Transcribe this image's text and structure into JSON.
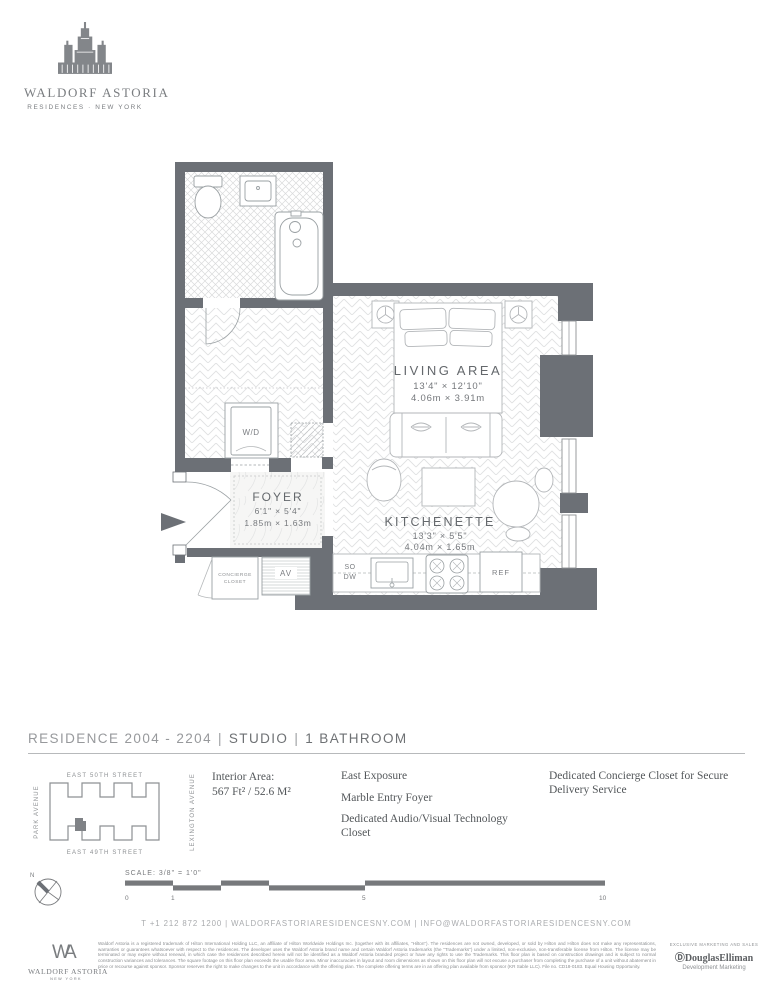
{
  "brand": {
    "name": "WALDORF ASTORIA",
    "subtitle": "RESIDENCES · NEW YORK"
  },
  "plan": {
    "living": {
      "label": "LIVING AREA",
      "dim_ft": "13'4\" × 12'10\"",
      "dim_m": "4.06m × 3.91m"
    },
    "kitchenette": {
      "label": "KITCHENETTE",
      "dim_ft": "13'3\" × 5'5\"",
      "dim_m": "4.04m × 1.65m"
    },
    "foyer": {
      "label": "FOYER",
      "dim_ft": "6'1\" × 5'4\"",
      "dim_m": "1.85m × 1.63m"
    },
    "wd": "W/D",
    "concierge_line1": "CONCIERGE",
    "concierge_line2": "CLOSET",
    "av": "AV",
    "so": "SO",
    "dw": "DW",
    "ref": "REF"
  },
  "residence": {
    "title_residence": "RESIDENCE 2004 - 2204",
    "title_type": "STUDIO",
    "title_bath": "1 BATHROOM",
    "sep": "|"
  },
  "keyplan": {
    "street_top": "EAST 50TH STREET",
    "street_bottom": "EAST 49TH STREET",
    "avenue_left": "PARK AVENUE",
    "avenue_right": "LEXINGTON AVENUE"
  },
  "details": {
    "interior_area_label": "Interior Area:",
    "interior_area_value": "567 Ft² / 52.6 M²",
    "features_col1": [
      "East Exposure",
      "Marble Entry Foyer",
      "Dedicated Audio/Visual Technology Closet"
    ],
    "features_col2": [
      "Dedicated Concierge Closet for Secure Delivery Service"
    ]
  },
  "scale": {
    "north": "N",
    "label": "SCALE: 3/8\" = 1'0\"",
    "ticks": [
      "0",
      "1",
      "5",
      "10"
    ]
  },
  "contact": "T +1 212 872 1200  |  WALDORFASTORIARESIDENCESNY.COM  |  INFO@WALDORFASTORIARESIDENCESNY.COM",
  "footer": {
    "monogram": "WA",
    "logo_name": "WALDORF ASTORIA",
    "logo_sub": "NEW YORK",
    "disclaimer": "Waldorf Astoria is a registered trademark of Hilton International Holding LLC, an affiliate of Hilton Worldwide Holdings Inc. (together with its affiliates, \"Hilton\"). The residences are not owned, developed, or sold by Hilton and Hilton does not make any representations, warranties or guarantees whatsoever with respect to the residences. The developer uses the Waldorf Astoria brand name and certain Waldorf Astoria trademarks (the \"Trademarks\") under a limited, non-exclusive, non-transferable license from Hilton. The license may be terminated or may expire without renewal, in which case the residences described herein will not be identified as a Waldorf Astoria branded project or have any rights to use the Trademarks. This floor plan is based on construction drawings and is subject to normal construction variances and tolerances. The square footage on this floor plan exceeds the usable floor area. Minor inaccuracies in layout and room dimensions as shown on this floor plan will not excuse a purchaser from completing the purchase of a unit without abatement in price or recourse against sponsor. Sponsor reserves the right to make changes to the unit in accordance with the offering plan. The complete offering terms are in an offering plan available from sponsor (KR Sable LLC). File no. CD18-0183. Equal Housing Opportunity.",
    "marketing_label": "EXCLUSIVE MARKETING AND SALES",
    "agency_mark": "Ⓓ",
    "agency": "DouglasElliman",
    "agency_sub": "Development Marketing"
  }
}
